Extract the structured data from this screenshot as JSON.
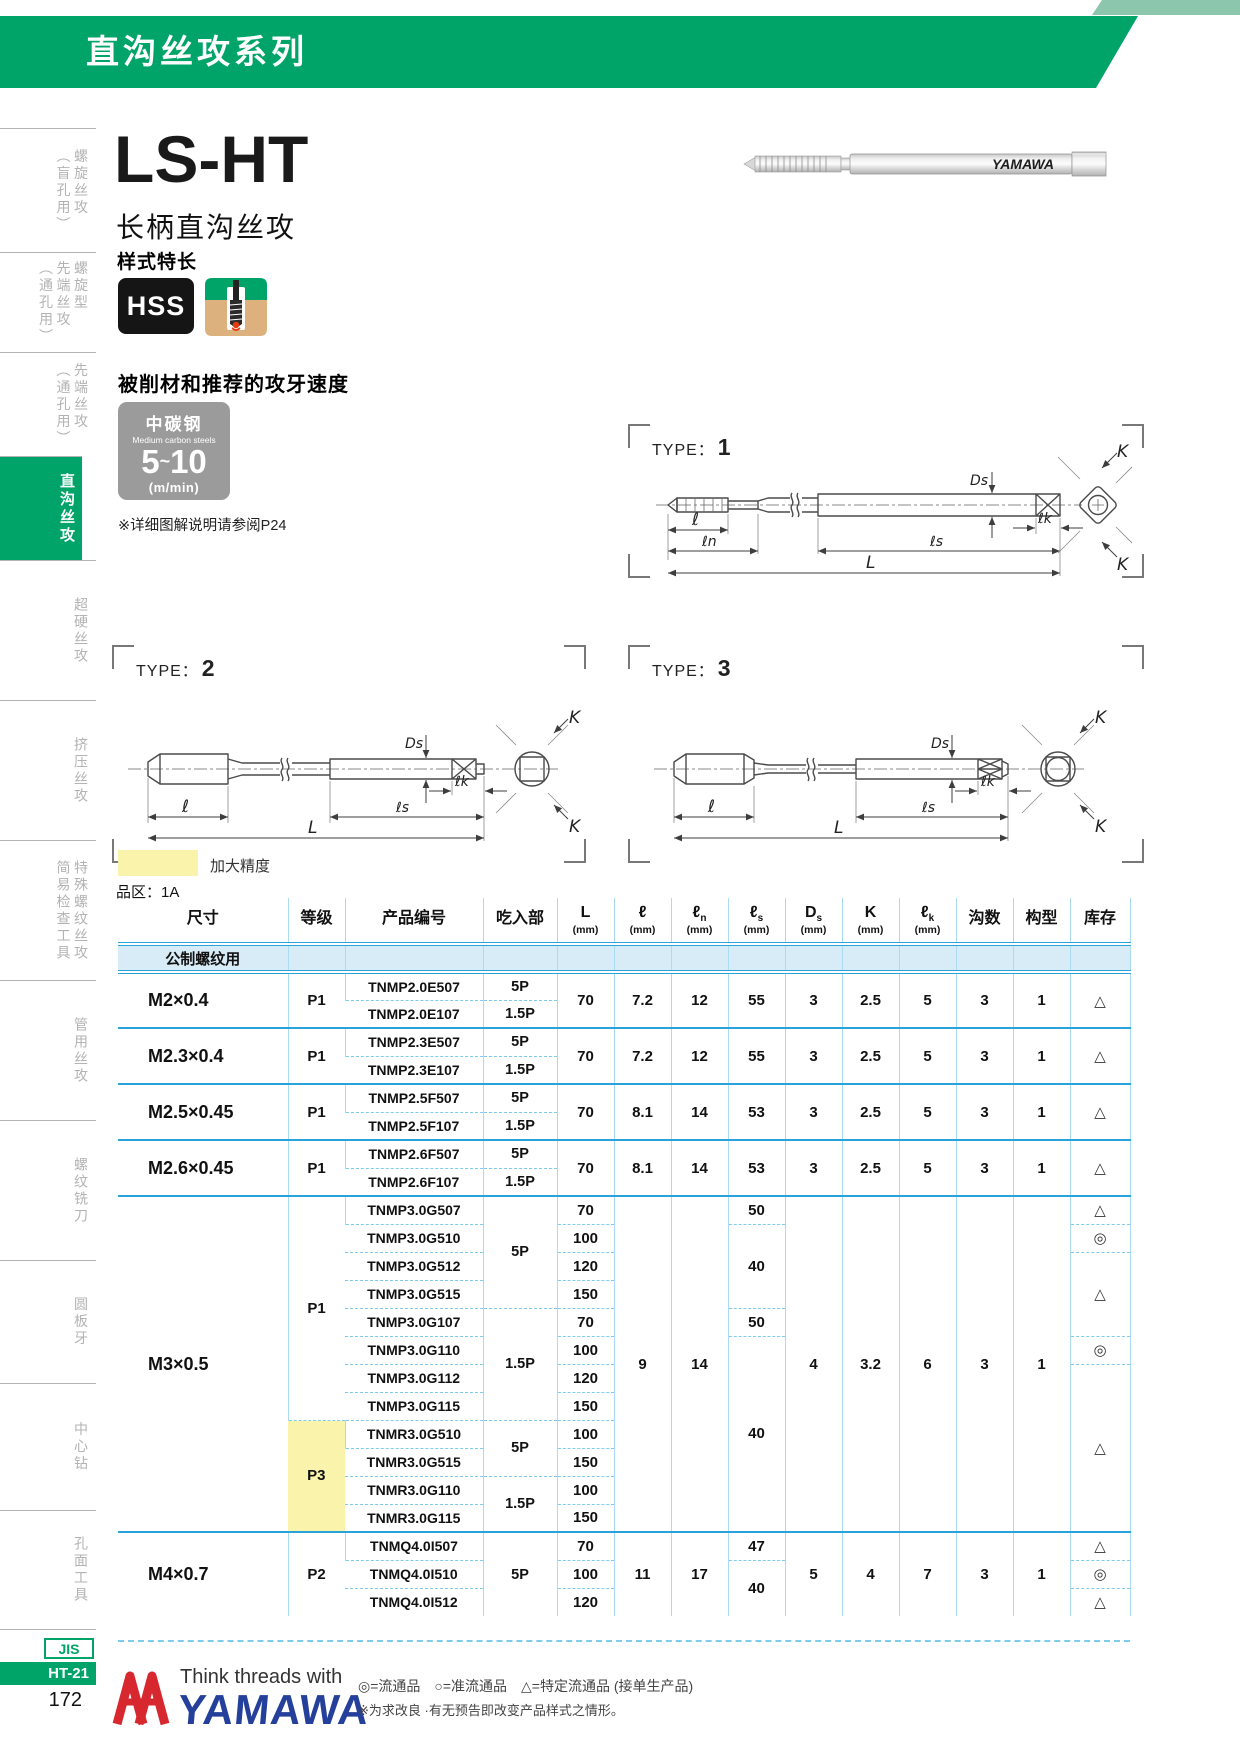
{
  "header": {
    "series": "直沟丝攻系列"
  },
  "product": {
    "model": "LS-HT",
    "name": "长柄直沟丝攻",
    "style": "样式特长",
    "material_badge": "HSS",
    "photo_brand": "YAMAWA"
  },
  "speed": {
    "section_title": "被削材和推荐的攻牙速度",
    "material_cn": "中碳钢",
    "material_en": "Medium carbon steels",
    "from": "5",
    "tilde": "~",
    "to": "10",
    "unit": "(m/min)",
    "note": "※详细图解说明请参阅P24"
  },
  "dw": {
    "prefix": "TYPE：",
    "ds": "Ds",
    "l": "ℓ",
    "ln": "ℓn",
    "ls": "ℓs",
    "lk": "ℓk",
    "L": "L",
    "k": "K"
  },
  "types": [
    {
      "num": "1"
    },
    {
      "num": "2"
    },
    {
      "num": "3"
    }
  ],
  "legend_hl": "加大精度",
  "zone": "品区：1A",
  "sidebar": {
    "items": [
      {
        "label": "螺旋丝攻\n（盲孔用）",
        "active": false
      },
      {
        "label": "螺旋型\n先端丝攻\n（通孔用）",
        "active": false
      },
      {
        "label": "先端丝攻\n（通孔用）",
        "active": false
      },
      {
        "label": "直沟丝攻",
        "active": true
      },
      {
        "label": "超硬丝攻",
        "active": false
      },
      {
        "label": "挤压丝攻",
        "active": false
      },
      {
        "label": "特殊螺纹丝攻\n简易检查工具",
        "active": false
      },
      {
        "label": "管用丝攻",
        "active": false
      },
      {
        "label": "螺纹铣刀",
        "active": false
      },
      {
        "label": "圆板牙",
        "active": false
      },
      {
        "label": "中心钻",
        "active": false
      },
      {
        "label": "孔面工具",
        "active": false
      }
    ],
    "footer": {
      "jis": "JIS",
      "code": "HT-21",
      "page": "172"
    }
  },
  "table": {
    "col_keys": [
      "size",
      "grade",
      "code",
      "chamfer",
      "L",
      "l",
      "ln",
      "ls",
      "ds",
      "k",
      "lk",
      "flutes",
      "form",
      "stock"
    ],
    "headers": [
      {
        "sym": "尺寸"
      },
      {
        "sym": "等级"
      },
      {
        "sym": "产品编号"
      },
      {
        "sym": "吃入部"
      },
      {
        "sym": "L",
        "unit": "(mm)"
      },
      {
        "sym": "ℓ",
        "unit": "(mm)"
      },
      {
        "sym": "ℓ",
        "sub": "n",
        "unit": "(mm)"
      },
      {
        "sym": "ℓ",
        "sub": "s",
        "unit": "(mm)"
      },
      {
        "sym": "D",
        "sub": "s",
        "unit": "(mm)"
      },
      {
        "sym": "K",
        "unit": "(mm)"
      },
      {
        "sym": "ℓ",
        "sub": "k",
        "unit": "(mm)"
      },
      {
        "sym": "沟数"
      },
      {
        "sym": "构型"
      },
      {
        "sym": "库存"
      }
    ],
    "subheader": "公制螺纹用",
    "groups": [
      {
        "rows": 2,
        "size": [
          {
            "t": "M2×0.4",
            "s": 2
          }
        ],
        "grade": [
          {
            "t": "P1",
            "s": 2
          }
        ],
        "code": [
          {
            "t": "TNMP2.0E507"
          },
          {
            "t": "TNMP2.0E107"
          }
        ],
        "chamfer": [
          {
            "t": "5P"
          },
          {
            "t": "1.5P"
          }
        ],
        "L": [
          {
            "t": "70",
            "s": 2
          }
        ],
        "l": [
          {
            "t": "7.2",
            "s": 2
          }
        ],
        "ln": [
          {
            "t": "12",
            "s": 2
          }
        ],
        "ls": [
          {
            "t": "55",
            "s": 2
          }
        ],
        "ds": [
          {
            "t": "3",
            "s": 2
          }
        ],
        "k": [
          {
            "t": "2.5",
            "s": 2
          }
        ],
        "lk": [
          {
            "t": "5",
            "s": 2
          }
        ],
        "flutes": [
          {
            "t": "3",
            "s": 2
          }
        ],
        "form": [
          {
            "t": "1",
            "s": 2
          }
        ],
        "stock": [
          {
            "t": "△",
            "s": 2
          }
        ]
      },
      {
        "rows": 2,
        "size": [
          {
            "t": "M2.3×0.4",
            "s": 2
          }
        ],
        "grade": [
          {
            "t": "P1",
            "s": 2
          }
        ],
        "code": [
          {
            "t": "TNMP2.3E507"
          },
          {
            "t": "TNMP2.3E107"
          }
        ],
        "chamfer": [
          {
            "t": "5P"
          },
          {
            "t": "1.5P"
          }
        ],
        "L": [
          {
            "t": "70",
            "s": 2
          }
        ],
        "l": [
          {
            "t": "7.2",
            "s": 2
          }
        ],
        "ln": [
          {
            "t": "12",
            "s": 2
          }
        ],
        "ls": [
          {
            "t": "55",
            "s": 2
          }
        ],
        "ds": [
          {
            "t": "3",
            "s": 2
          }
        ],
        "k": [
          {
            "t": "2.5",
            "s": 2
          }
        ],
        "lk": [
          {
            "t": "5",
            "s": 2
          }
        ],
        "flutes": [
          {
            "t": "3",
            "s": 2
          }
        ],
        "form": [
          {
            "t": "1",
            "s": 2
          }
        ],
        "stock": [
          {
            "t": "△",
            "s": 2
          }
        ]
      },
      {
        "rows": 2,
        "size": [
          {
            "t": "M2.5×0.45",
            "s": 2
          }
        ],
        "grade": [
          {
            "t": "P1",
            "s": 2
          }
        ],
        "code": [
          {
            "t": "TNMP2.5F507"
          },
          {
            "t": "TNMP2.5F107"
          }
        ],
        "chamfer": [
          {
            "t": "5P"
          },
          {
            "t": "1.5P"
          }
        ],
        "L": [
          {
            "t": "70",
            "s": 2
          }
        ],
        "l": [
          {
            "t": "8.1",
            "s": 2
          }
        ],
        "ln": [
          {
            "t": "14",
            "s": 2
          }
        ],
        "ls": [
          {
            "t": "53",
            "s": 2
          }
        ],
        "ds": [
          {
            "t": "3",
            "s": 2
          }
        ],
        "k": [
          {
            "t": "2.5",
            "s": 2
          }
        ],
        "lk": [
          {
            "t": "5",
            "s": 2
          }
        ],
        "flutes": [
          {
            "t": "3",
            "s": 2
          }
        ],
        "form": [
          {
            "t": "1",
            "s": 2
          }
        ],
        "stock": [
          {
            "t": "△",
            "s": 2
          }
        ]
      },
      {
        "rows": 2,
        "size": [
          {
            "t": "M2.6×0.45",
            "s": 2
          }
        ],
        "grade": [
          {
            "t": "P1",
            "s": 2
          }
        ],
        "code": [
          {
            "t": "TNMP2.6F507"
          },
          {
            "t": "TNMP2.6F107"
          }
        ],
        "chamfer": [
          {
            "t": "5P"
          },
          {
            "t": "1.5P"
          }
        ],
        "L": [
          {
            "t": "70",
            "s": 2
          }
        ],
        "l": [
          {
            "t": "8.1",
            "s": 2
          }
        ],
        "ln": [
          {
            "t": "14",
            "s": 2
          }
        ],
        "ls": [
          {
            "t": "53",
            "s": 2
          }
        ],
        "ds": [
          {
            "t": "3",
            "s": 2
          }
        ],
        "k": [
          {
            "t": "2.5",
            "s": 2
          }
        ],
        "lk": [
          {
            "t": "5",
            "s": 2
          }
        ],
        "flutes": [
          {
            "t": "3",
            "s": 2
          }
        ],
        "form": [
          {
            "t": "1",
            "s": 2
          }
        ],
        "stock": [
          {
            "t": "△",
            "s": 2
          }
        ]
      },
      {
        "rows": 12,
        "size": [
          {
            "t": "M3×0.5",
            "s": 12
          }
        ],
        "grade": [
          {
            "t": "P1",
            "s": 8
          },
          {
            "t": "P3",
            "s": 4,
            "hl": true
          }
        ],
        "code": [
          {
            "t": "TNMP3.0G507"
          },
          {
            "t": "TNMP3.0G510"
          },
          {
            "t": "TNMP3.0G512"
          },
          {
            "t": "TNMP3.0G515"
          },
          {
            "t": "TNMP3.0G107"
          },
          {
            "t": "TNMP3.0G110"
          },
          {
            "t": "TNMP3.0G112"
          },
          {
            "t": "TNMP3.0G115"
          },
          {
            "t": "TNMR3.0G510"
          },
          {
            "t": "TNMR3.0G515"
          },
          {
            "t": "TNMR3.0G110"
          },
          {
            "t": "TNMR3.0G115"
          }
        ],
        "chamfer": [
          {
            "t": "5P",
            "s": 4
          },
          {
            "t": "1.5P",
            "s": 4
          },
          {
            "t": "5P",
            "s": 2
          },
          {
            "t": "1.5P",
            "s": 2
          }
        ],
        "L": [
          {
            "t": "70"
          },
          {
            "t": "100"
          },
          {
            "t": "120"
          },
          {
            "t": "150"
          },
          {
            "t": "70"
          },
          {
            "t": "100"
          },
          {
            "t": "120"
          },
          {
            "t": "150"
          },
          {
            "t": "100"
          },
          {
            "t": "150"
          },
          {
            "t": "100"
          },
          {
            "t": "150"
          }
        ],
        "l": [
          {
            "t": "9",
            "s": 12
          }
        ],
        "ln": [
          {
            "t": "14",
            "s": 12
          }
        ],
        "ls": [
          {
            "t": "50"
          },
          {
            "t": "40",
            "s": 3
          },
          {
            "t": "50"
          },
          {
            "t": "40",
            "s": 7
          }
        ],
        "ds": [
          {
            "t": "4",
            "s": 12
          }
        ],
        "k": [
          {
            "t": "3.2",
            "s": 12
          }
        ],
        "lk": [
          {
            "t": "6",
            "s": 12
          }
        ],
        "flutes": [
          {
            "t": "3",
            "s": 12
          }
        ],
        "form": [
          {
            "t": "1",
            "s": 12
          }
        ],
        "stock": [
          {
            "t": "△"
          },
          {
            "t": "◎"
          },
          {
            "t": "△",
            "s": 3
          },
          {
            "t": "◎"
          },
          {
            "t": "△",
            "s": 6
          }
        ]
      },
      {
        "rows": 3,
        "size": [
          {
            "t": "M4×0.7",
            "s": 3
          }
        ],
        "grade": [
          {
            "t": "P2",
            "s": 3
          }
        ],
        "code": [
          {
            "t": "TNMQ4.0I507"
          },
          {
            "t": "TNMQ4.0I510"
          },
          {
            "t": "TNMQ4.0I512"
          }
        ],
        "chamfer": [
          {
            "t": "5P",
            "s": 3
          }
        ],
        "L": [
          {
            "t": "70"
          },
          {
            "t": "100"
          },
          {
            "t": "120"
          }
        ],
        "l": [
          {
            "t": "11",
            "s": 3
          }
        ],
        "ln": [
          {
            "t": "17",
            "s": 3
          }
        ],
        "ls": [
          {
            "t": "47"
          },
          {
            "t": "40",
            "s": 2
          }
        ],
        "ds": [
          {
            "t": "5",
            "s": 3
          }
        ],
        "k": [
          {
            "t": "4",
            "s": 3
          }
        ],
        "lk": [
          {
            "t": "7",
            "s": 3
          }
        ],
        "flutes": [
          {
            "t": "3",
            "s": 3
          }
        ],
        "form": [
          {
            "t": "1",
            "s": 3
          }
        ],
        "stock": [
          {
            "t": "△"
          },
          {
            "t": "◎"
          },
          {
            "t": "△"
          }
        ]
      }
    ]
  },
  "footer": {
    "tagline": "Think threads with",
    "brand": "YAMAWA",
    "legend": "◎=流通品　○=准流通品　△=特定流通品 (接单生产品)",
    "note": "※为求改良 ·有无预告即改变产品样式之情形。"
  }
}
